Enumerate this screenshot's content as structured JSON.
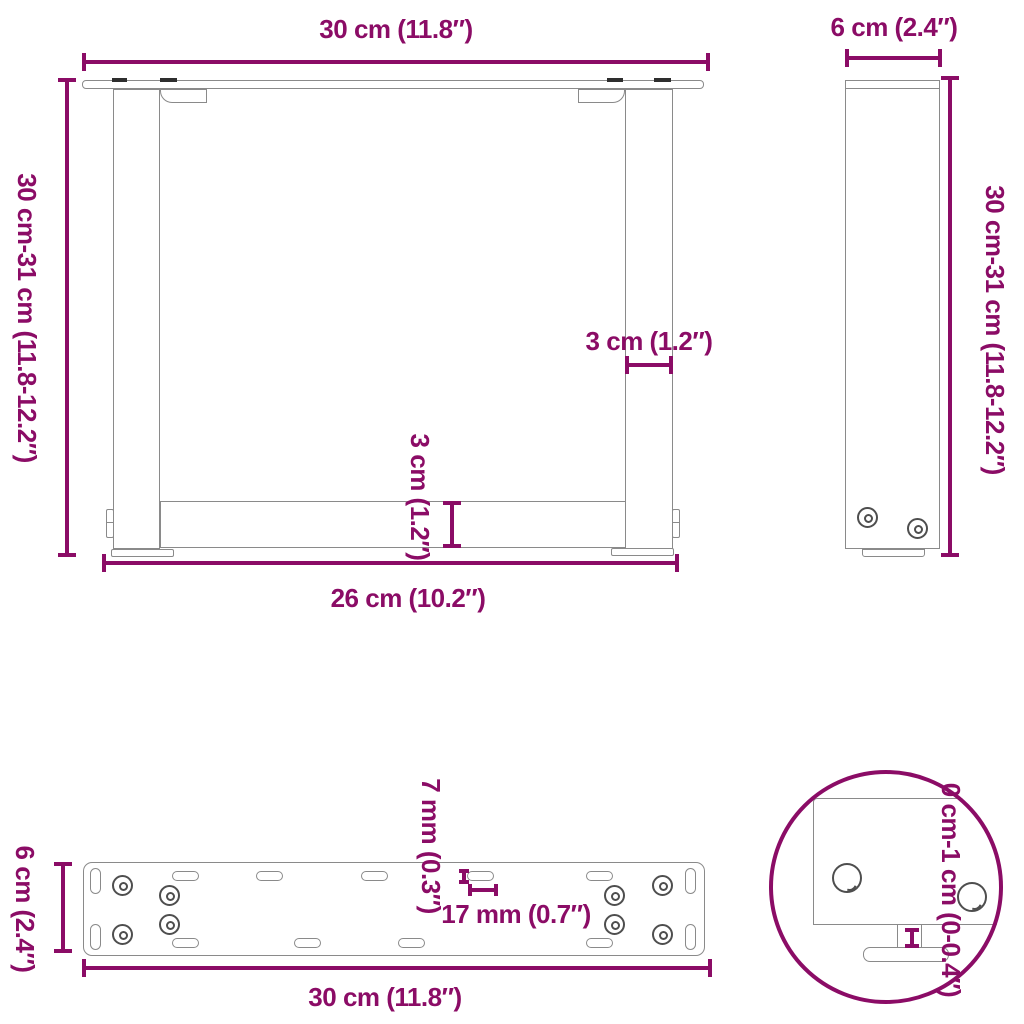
{
  "colors": {
    "accent": "#8B0C66",
    "outline": "#8A8A8A",
    "screw": "#4E4E4E",
    "dark": "#2E2E2E"
  },
  "front_view": {
    "top_width": "30 cm (11.8″)",
    "height_range": "30 cm-31 cm (11.8-12.2″)",
    "leg_thickness": "3 cm (1.2″)",
    "crossbar_thickness": "3 cm (1.2″)",
    "inner_width": "26 cm (10.2″)"
  },
  "side_view": {
    "depth": "6 cm (2.4″)",
    "height_range": "30 cm-31 cm (11.8-12.2″)"
  },
  "plate_view": {
    "depth": "6 cm (2.4″)",
    "width": "30 cm (11.8″)",
    "slot_height": "7 mm (0.3″)",
    "slot_pitch": "17 mm (0.7″)"
  },
  "detail_view": {
    "adjustable_range": "0 cm-1 cm (0-0.4″)"
  }
}
